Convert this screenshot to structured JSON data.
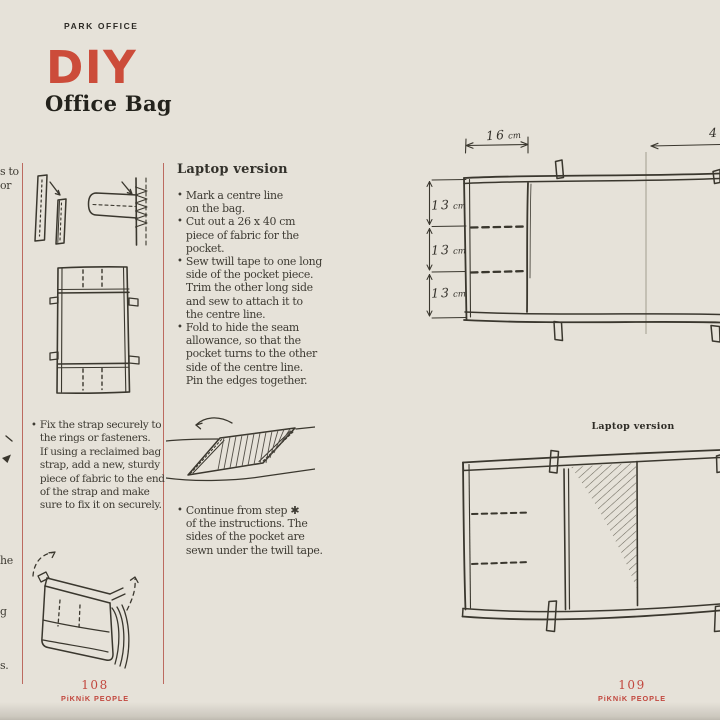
{
  "colors": {
    "background": "#e6e2d9",
    "ink": "#3a372e",
    "text": "#3e3b33",
    "accent_red": "#cc4c3a",
    "footer_red": "#c2473e",
    "rule_red": "#bc6a60"
  },
  "header": {
    "kicker": "PARK OFFICE",
    "title": "DIY",
    "subtitle": "Office Bag"
  },
  "edge_fragments": {
    "f1": "s to",
    "f2": "or",
    "f3": "he",
    "f4": "g",
    "f5": "s."
  },
  "left_column": {
    "bullet_char": "•",
    "strap_note": "Fix the strap securely to\nthe rings or fasteners.\nIf using a reclaimed bag\nstrap, add a new, sturdy\npiece of fabric to the end\nof the strap and make\nsure to fix it on securely."
  },
  "instructions": {
    "bullet_char": "•",
    "heading": "Laptop version",
    "steps": [
      {
        "text": "Mark a centre line\non the bag."
      },
      {
        "text": "Cut out a 26 x 40 cm\npiece of fabric for the\npocket."
      },
      {
        "text": "Sew twill tape to one long\nside of the pocket piece.\nTrim the other long side\nand sew to attach it to\nthe centre line."
      },
      {
        "text": "Fold to hide the seam\nallowance, so that the\npocket turns to the other\nside of the centre line.\nPin the edges together."
      }
    ],
    "continue_note": "Continue from step ✱\nof the instructions. The\nsides of the pocket are\nsewn under the twill tape."
  },
  "diagram_top": {
    "width_label": {
      "value": "16",
      "unit": "cm"
    },
    "width_label_right": {
      "value": "4",
      "unit": ""
    },
    "height_labels": [
      {
        "value": "13",
        "unit": "cm"
      },
      {
        "value": "13",
        "unit": "cm"
      },
      {
        "value": "13",
        "unit": "cm"
      }
    ]
  },
  "diagram_bottom": {
    "label": "Laptop version"
  },
  "footers": {
    "left": {
      "page_number": "108",
      "brand": "PiKNiK PEOPLE"
    },
    "right": {
      "page_number": "109",
      "brand": "PiKNiK PEOPLE"
    }
  }
}
